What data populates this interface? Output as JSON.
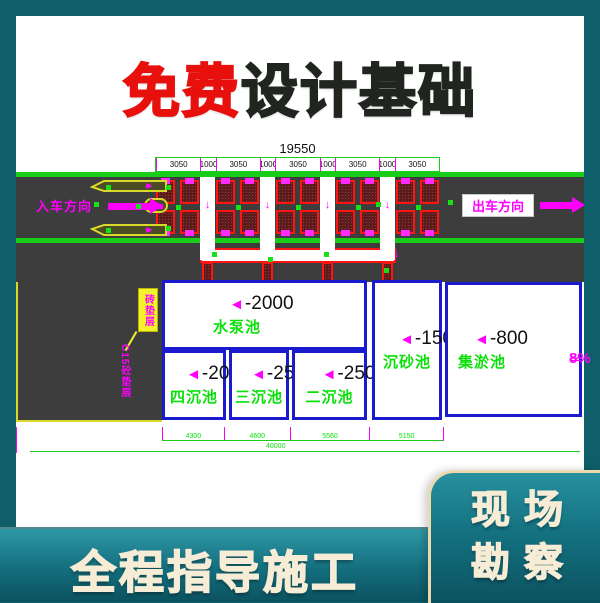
{
  "title": {
    "red_part": "免费",
    "dark_part": "设计基础"
  },
  "footer": {
    "label": "全程指导施工"
  },
  "badge": {
    "line1": "现场",
    "line2": "勘察"
  },
  "drawing": {
    "dim_total_top": "19550",
    "dim_segments_top": [
      "3050",
      "1000",
      "3050",
      "1000",
      "3050",
      "1000",
      "3050",
      "1000",
      "3050"
    ],
    "entry_direction": "入车方向",
    "exit_direction": "出车方向",
    "annotation_brick": "砖垫层",
    "annotation_cushion": "C15砼垫层",
    "slope_value": "8%",
    "pools": [
      {
        "depth": "-2000",
        "name": "水泵池"
      },
      {
        "depth": "-2000",
        "name": "四沉池"
      },
      {
        "depth": "-2500",
        "name": "三沉池"
      },
      {
        "depth": "-2500",
        "name": "二沉池"
      },
      {
        "depth": "-1500",
        "name": "沉砂池"
      },
      {
        "depth": "-800",
        "name": "集淤池"
      }
    ],
    "dim_segments_bottom": [
      "4300",
      "4600",
      "5560",
      "5150"
    ],
    "dim_total_bottom": "40000"
  },
  "glyphs": {
    "depth_marker": "◄",
    "slope_arrow": "⇐",
    "channel_arrow": "↓"
  },
  "colors": {
    "frame_teal": "#0E5F6A",
    "footer_top": "#2E98A6",
    "footer_bottom": "#0B5260",
    "badge_border": "#EDD9AE",
    "cream_text": "#F7EDD6",
    "title_red": "#E8100C",
    "title_dark": "#20261F",
    "cad_green": "#17CD17",
    "cad_text_green": "#0BE00B",
    "cad_magenta": "#FF00FF",
    "cad_red": "#FF1414",
    "cad_blue": "#1A1ACF",
    "road_gray": "#3D3D3D",
    "hatch_fill": "#5A1D1D",
    "hatch_dot": "#A43535",
    "island_yellow": "#D9D92B",
    "annotation_yellow": "#F2F22E"
  }
}
